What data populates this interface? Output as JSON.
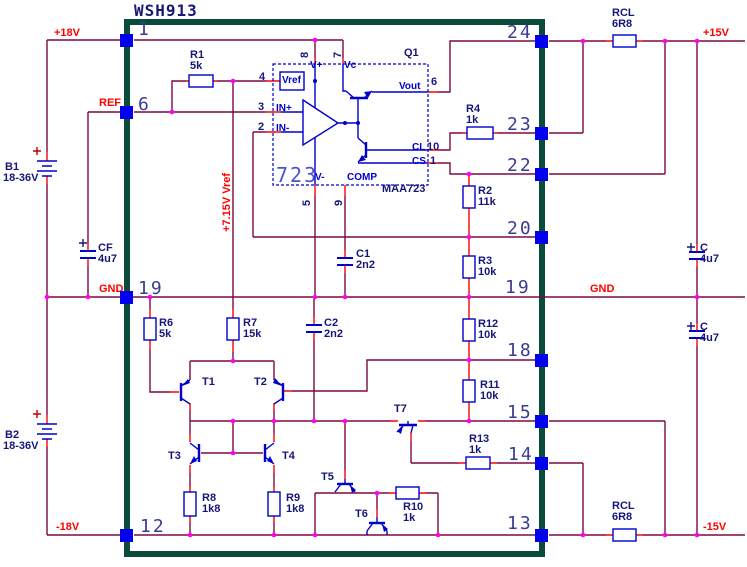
{
  "title": {
    "text": "WSH913"
  },
  "colors": {
    "wire": "#7b0a45",
    "stub": "#ff0000",
    "junction": "#ff00ff",
    "component": "#0000cc",
    "pin_square": "#0000ee",
    "border": "#0b4b3c",
    "net_label": "#ff0000",
    "part_label": "#16167a",
    "pin_number": "#3b3b94",
    "background": "#ffffff"
  },
  "nets": [
    {
      "name": "+18V",
      "x": 54,
      "y": 28,
      "rot": false
    },
    {
      "name": "REF",
      "x": 99,
      "y": 98,
      "rot": false
    },
    {
      "name": "GND",
      "x": 99,
      "y": 284,
      "rot": false
    },
    {
      "name": "-18V",
      "x": 56,
      "y": 522,
      "rot": false
    },
    {
      "name": "+15V",
      "x": 703,
      "y": 28,
      "rot": false
    },
    {
      "name": "GND",
      "x": 590,
      "y": 284,
      "rot": false
    },
    {
      "name": "-15V",
      "x": 703,
      "y": 522,
      "rot": false
    },
    {
      "name": "+7.15V Vref",
      "x": 222,
      "y": 232,
      "rot": true
    }
  ],
  "pins": {
    "left": [
      {
        "n": "1",
        "lx": 138,
        "ly": 19,
        "sy": 40
      },
      {
        "n": "6",
        "lx": 138,
        "ly": 94,
        "sy": 112
      },
      {
        "n": "19",
        "lx": 138,
        "ly": 278,
        "sy": 297
      },
      {
        "n": "12",
        "lx": 140,
        "ly": 516,
        "sy": 535
      }
    ],
    "right": [
      {
        "n": "24",
        "lx": 507,
        "ly": 22,
        "sy": 41
      },
      {
        "n": "23",
        "lx": 507,
        "ly": 114,
        "sy": 133
      },
      {
        "n": "22",
        "lx": 507,
        "ly": 155,
        "sy": 174
      },
      {
        "n": "20",
        "lx": 507,
        "ly": 218,
        "sy": 237
      },
      {
        "n": "19",
        "lx": 505,
        "ly": 277,
        "sy": null
      },
      {
        "n": "18",
        "lx": 507,
        "ly": 340,
        "sy": 360
      },
      {
        "n": "15",
        "lx": 507,
        "ly": 402,
        "sy": 421
      },
      {
        "n": "14",
        "lx": 508,
        "ly": 444,
        "sy": 463
      },
      {
        "n": "13",
        "lx": 507,
        "ly": 513,
        "sy": 535
      }
    ]
  },
  "components": [
    {
      "ref": "R1",
      "value": "5k",
      "rx": 190,
      "ry": 50,
      "vx": 190,
      "vy": 61
    },
    {
      "ref": "R2",
      "value": "11k",
      "rx": 478,
      "ry": 186,
      "vx": 478,
      "vy": 197
    },
    {
      "ref": "R3",
      "value": "10k",
      "rx": 478,
      "ry": 256,
      "vx": 478,
      "vy": 267
    },
    {
      "ref": "R4",
      "value": "1k",
      "rx": 466,
      "ry": 104,
      "vx": 466,
      "vy": 115
    },
    {
      "ref": "R6",
      "value": "5k",
      "rx": 159,
      "ry": 318,
      "vx": 159,
      "vy": 329
    },
    {
      "ref": "R7",
      "value": "15k",
      "rx": 243,
      "ry": 318,
      "vx": 243,
      "vy": 329
    },
    {
      "ref": "R8",
      "value": "1k8",
      "rx": 202,
      "ry": 493,
      "vx": 202,
      "vy": 504
    },
    {
      "ref": "R9",
      "value": "1k8",
      "rx": 286,
      "ry": 493,
      "vx": 286,
      "vy": 504
    },
    {
      "ref": "R10",
      "value": "1k",
      "rx": 403,
      "ry": 502,
      "vx": 403,
      "vy": 513
    },
    {
      "ref": "R11",
      "value": "10k",
      "rx": 480,
      "ry": 380,
      "vx": 480,
      "vy": 391
    },
    {
      "ref": "R12",
      "value": "10k",
      "rx": 478,
      "ry": 319,
      "vx": 478,
      "vy": 330
    },
    {
      "ref": "R13",
      "value": "1k",
      "rx": 469,
      "ry": 434,
      "vx": 469,
      "vy": 445
    },
    {
      "ref": "RCL",
      "value": "6R8",
      "rx": 612,
      "ry": 8,
      "vx": 612,
      "vy": 19
    },
    {
      "ref": "RCL",
      "value": "6R8",
      "rx": 612,
      "ry": 501,
      "vx": 612,
      "vy": 512
    },
    {
      "ref": "C1",
      "value": "2n2",
      "rx": 356,
      "ry": 249,
      "vx": 356,
      "vy": 260
    },
    {
      "ref": "C2",
      "value": "2n2",
      "rx": 324,
      "ry": 318,
      "vx": 324,
      "vy": 329
    },
    {
      "ref": "CF",
      "value": "4u7",
      "rx": 98,
      "ry": 243,
      "vx": 98,
      "vy": 254
    },
    {
      "ref": "C",
      "value": "4u7",
      "rx": 700,
      "ry": 243,
      "vx": 700,
      "vy": 254
    },
    {
      "ref": "C",
      "value": "4u7",
      "rx": 700,
      "ry": 322,
      "vx": 700,
      "vy": 333
    },
    {
      "ref": "B1",
      "value": "18-36V",
      "rx": 5,
      "ry": 162,
      "vx": 3,
      "vy": 173
    },
    {
      "ref": "B2",
      "value": "18-36V",
      "rx": 5,
      "ry": 430,
      "vx": 3,
      "vy": 441
    }
  ],
  "transistors": [
    {
      "ref": "T1",
      "x": 202,
      "y": 377
    },
    {
      "ref": "T2",
      "x": 254,
      "y": 377
    },
    {
      "ref": "T3",
      "x": 168,
      "y": 451
    },
    {
      "ref": "T4",
      "x": 282,
      "y": 451
    },
    {
      "ref": "T5",
      "x": 321,
      "y": 472
    },
    {
      "ref": "T6",
      "x": 355,
      "y": 509
    },
    {
      "ref": "T7",
      "x": 394,
      "y": 404
    },
    {
      "ref": "Q1",
      "x": 404,
      "y": 48
    }
  ],
  "ic": {
    "big_label": "723",
    "big_x": 276,
    "big_y": 163,
    "part": "MAA723",
    "part_x": 382,
    "part_y": 184,
    "ports": [
      {
        "name": "Vref",
        "x": 282,
        "y": 76
      },
      {
        "name": "V+",
        "x": 310,
        "y": 61
      },
      {
        "name": "Vc",
        "x": 344,
        "y": 61
      },
      {
        "name": "V-",
        "x": 315,
        "y": 173
      },
      {
        "name": "COMP",
        "x": 347,
        "y": 173
      },
      {
        "name": "Vout",
        "x": 399,
        "y": 82
      },
      {
        "name": "CL",
        "x": 412,
        "y": 143
      },
      {
        "name": "CS",
        "x": 412,
        "y": 157
      },
      {
        "name": "IN+",
        "x": 276,
        "y": 104
      },
      {
        "name": "IN-",
        "x": 276,
        "y": 124
      }
    ],
    "pin_numbers": [
      {
        "n": "4",
        "x": 259,
        "y": 72,
        "rot": false
      },
      {
        "n": "3",
        "x": 258,
        "y": 102,
        "rot": false
      },
      {
        "n": "2",
        "x": 258,
        "y": 122,
        "rot": false
      },
      {
        "n": "8",
        "x": 300,
        "y": 58,
        "rot": true
      },
      {
        "n": "7",
        "x": 333,
        "y": 58,
        "rot": true
      },
      {
        "n": "5",
        "x": 302,
        "y": 206,
        "rot": true
      },
      {
        "n": "9",
        "x": 334,
        "y": 206,
        "rot": true
      },
      {
        "n": "6",
        "x": 431,
        "y": 77,
        "rot": false
      },
      {
        "n": "10",
        "x": 427,
        "y": 142,
        "rot": false
      },
      {
        "n": "1",
        "x": 430,
        "y": 156,
        "rot": false
      }
    ]
  }
}
